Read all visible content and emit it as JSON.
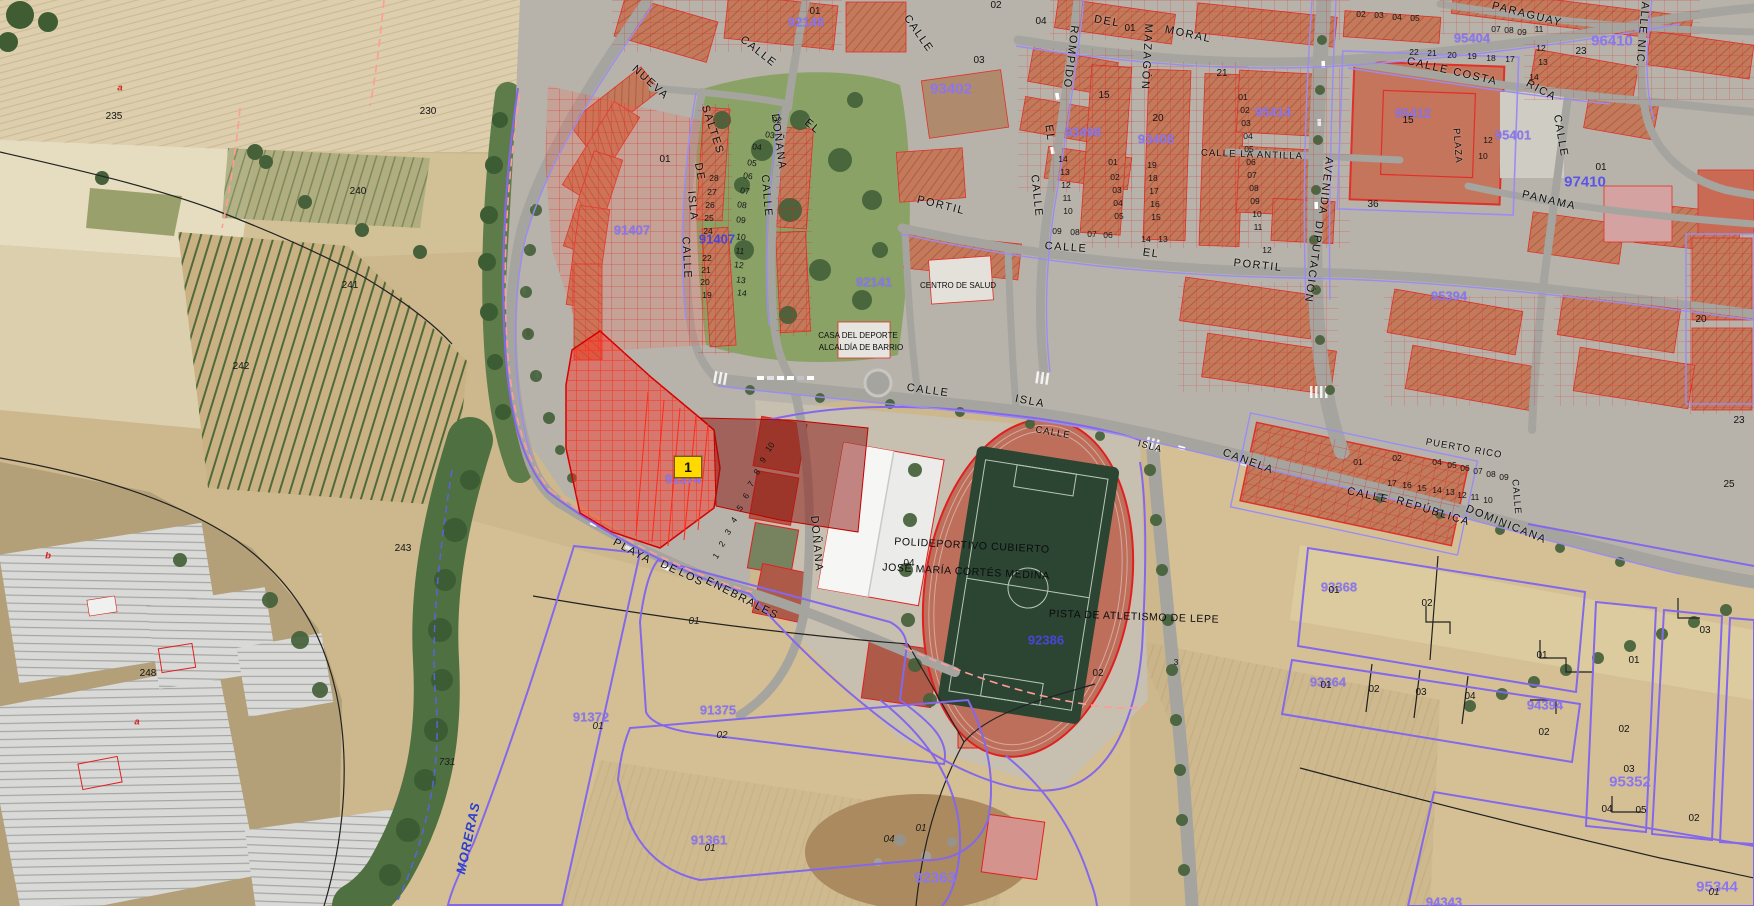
{
  "colors": {
    "cadastral_red": "#e02020",
    "boundary_purple": "#8468ec",
    "parcel_number_purple": "#8a76ee",
    "parcel_number_blue": "#4746d6",
    "selected_parcel_fill": "#ff2e20",
    "marker_yellow": "#ffd900",
    "water_label_blue": "#2b3fd0",
    "field_tan": "#cdb88e",
    "roof_terracotta": "#c5795b",
    "pitch_green": "#2c4533",
    "track_red": "#bd6f5b"
  },
  "selected_parcel": {
    "marker_label": "1",
    "parcel_number": "91374"
  },
  "facilities": {
    "sports_hall_line1": "POLIDEPORTIVO CUBIERTO",
    "sports_hall_line2": "JOSÉ MARÍA CORTÉS MEDINA",
    "athletics_track": "PISTA DE ATLETISMO DE LEPE",
    "health_center": "CENTRO DE SALUD",
    "sports_house_line1": "CASA DEL DEPORTE",
    "sports_house_line2": "ALCALDÍA DE BARRIO"
  },
  "map_labels": [
    [
      "CALLE",
      758,
      52,
      38,
      "st"
    ],
    [
      "NUEVA",
      650,
      83,
      42,
      "st"
    ],
    [
      "SALTES",
      712,
      130,
      72,
      "st"
    ],
    [
      "DE",
      699,
      172,
      80,
      "st"
    ],
    [
      "ISLA",
      692,
      206,
      84,
      "st"
    ],
    [
      "CALLE",
      686,
      258,
      87,
      "st"
    ],
    [
      "DOÑANA",
      778,
      142,
      82,
      "st"
    ],
    [
      "CALLE",
      766,
      196,
      85,
      "st"
    ],
    [
      "EL",
      812,
      127,
      40,
      "st"
    ],
    [
      "CALLE",
      918,
      34,
      55,
      "st"
    ],
    [
      "DEL",
      1107,
      22,
      10,
      "st"
    ],
    [
      "MORAL",
      1188,
      35,
      12,
      "st"
    ],
    [
      "ROMPIDO",
      1070,
      57,
      97,
      "st"
    ],
    [
      "EL",
      1049,
      133,
      82,
      "st"
    ],
    [
      "CALLE",
      1036,
      196,
      84,
      "st"
    ],
    [
      "MAZAGÓN",
      1146,
      57,
      93,
      "st"
    ],
    [
      "PORTIL",
      941,
      206,
      14,
      "st"
    ],
    [
      "CALLE",
      1066,
      248,
      4,
      "st"
    ],
    [
      "EL",
      1151,
      254,
      8,
      "st"
    ],
    [
      "PORTIL",
      1258,
      266,
      6,
      "st"
    ],
    [
      "CALLE COSTA",
      1452,
      72,
      13,
      "st"
    ],
    [
      "RICA",
      1541,
      91,
      28,
      "st"
    ],
    [
      "PARAGUAY",
      1527,
      15,
      14,
      "st"
    ],
    [
      "PANAMA",
      1549,
      201,
      13,
      "st"
    ],
    [
      "CALLE",
      1560,
      136,
      80,
      "st"
    ],
    [
      "CALLE NIC.",
      1642,
      30,
      95,
      "st"
    ],
    [
      "AVENIDA",
      1325,
      186,
      97,
      "st"
    ],
    [
      "DIPUTACIÓN",
      1313,
      262,
      98,
      "st"
    ],
    [
      "CALLE LA ANTILLA",
      1252,
      155,
      2,
      "stS"
    ],
    [
      "PLAZA",
      1457,
      146,
      86,
      "stS"
    ],
    [
      "CALLE",
      1368,
      496,
      12,
      "st"
    ],
    [
      "REPÚBLICA",
      1433,
      512,
      17,
      "st"
    ],
    [
      "DOMINICANA",
      1506,
      525,
      22,
      "st"
    ],
    [
      "PUERTO RICO",
      1464,
      449,
      10,
      "stS"
    ],
    [
      "CALLE",
      928,
      391,
      8,
      "st"
    ],
    [
      "ISLA",
      1030,
      402,
      11,
      "st"
    ],
    [
      "CALLE",
      1053,
      433,
      10,
      "stS"
    ],
    [
      "ISLA",
      1150,
      447,
      15,
      "stS"
    ],
    [
      "CANELA",
      1248,
      462,
      20,
      "st"
    ],
    [
      "PLAYA",
      632,
      552,
      28,
      "st"
    ],
    [
      "DE",
      669,
      568,
      26,
      "st"
    ],
    [
      "LOS",
      691,
      578,
      26,
      "st"
    ],
    [
      "ENEBRALES",
      742,
      599,
      27,
      "st"
    ],
    [
      "DOÑANA",
      816,
      544,
      85,
      "st"
    ],
    [
      "CALLE",
      1516,
      497,
      85,
      "stS"
    ],
    [
      "MORERAS",
      468,
      838,
      -78,
      "wat"
    ],
    [
      "POLIDEPORTIVO CUBIERTO",
      972,
      546,
      3,
      "fac"
    ],
    [
      "JOSÉ MARÍA CORTÉS MEDINA",
      966,
      572,
      3,
      "fac"
    ],
    [
      "PISTA DE ATLETISMO DE LEPE",
      1134,
      617,
      2,
      "fac"
    ],
    [
      "CENTRO DE SALUD",
      958,
      286,
      0,
      "f8"
    ],
    [
      "CASA DEL DEPORTE",
      858,
      336,
      0,
      "f8"
    ],
    [
      "ALCALDÍA DE BARRIO",
      861,
      348,
      0,
      "f8"
    ],
    [
      "92148",
      806,
      22,
      0,
      "pn"
    ],
    [
      "91407",
      632,
      230,
      0,
      "pn"
    ],
    [
      "91407",
      717,
      239,
      0,
      "pnb"
    ],
    [
      "92141",
      874,
      282,
      0,
      "pn"
    ],
    [
      "93402",
      951,
      89,
      0,
      "pnL"
    ],
    [
      "93498",
      1083,
      132,
      0,
      "pn"
    ],
    [
      "93408",
      1156,
      139,
      0,
      "pn"
    ],
    [
      "95414",
      1273,
      112,
      0,
      "pn"
    ],
    [
      "95412",
      1413,
      113,
      0,
      "pn"
    ],
    [
      "95404",
      1472,
      38,
      0,
      "pn"
    ],
    [
      "95401",
      1513,
      135,
      0,
      "pn"
    ],
    [
      "95394",
      1449,
      296,
      0,
      "pn"
    ],
    [
      "96410",
      1612,
      41,
      0,
      "pnL"
    ],
    [
      "97410",
      1585,
      182,
      0,
      "pnbL"
    ],
    [
      "92386",
      1046,
      640,
      0,
      "pnb"
    ],
    [
      "91372",
      591,
      717,
      0,
      "pn"
    ],
    [
      "91375",
      718,
      710,
      0,
      "pn"
    ],
    [
      "91361",
      709,
      840,
      0,
      "pn"
    ],
    [
      "92363",
      935,
      878,
      0,
      "pnL"
    ],
    [
      "93368",
      1339,
      587,
      0,
      "pn"
    ],
    [
      "93364",
      1328,
      682,
      0,
      "pn"
    ],
    [
      "94394",
      1545,
      705,
      0,
      "pn"
    ],
    [
      "95352",
      1630,
      782,
      0,
      "pnL"
    ],
    [
      "95344",
      1717,
      887,
      0,
      "pnL"
    ],
    [
      "94343",
      1444,
      902,
      0,
      "pn"
    ],
    [
      "91374",
      683,
      479,
      0,
      "pn"
    ],
    [
      "235",
      114,
      117,
      0,
      "n"
    ],
    [
      "230",
      428,
      112,
      0,
      "n"
    ],
    [
      "240",
      358,
      192,
      0,
      "n"
    ],
    [
      "241",
      350,
      286,
      0,
      "n"
    ],
    [
      "242",
      241,
      367,
      0,
      "n"
    ],
    [
      "243",
      403,
      549,
      0,
      "n"
    ],
    [
      "248",
      148,
      674,
      0,
      "n"
    ],
    [
      "731",
      447,
      763,
      0,
      "ni"
    ],
    [
      "a",
      120,
      88,
      0,
      "nr"
    ],
    [
      "b",
      48,
      556,
      0,
      "nr"
    ],
    [
      "a",
      137,
      722,
      0,
      "nr"
    ],
    [
      "01",
      598,
      727,
      0,
      "ni"
    ],
    [
      "02",
      722,
      736,
      0,
      "ni"
    ],
    [
      "01",
      710,
      849,
      0,
      "ni"
    ],
    [
      "04",
      889,
      840,
      0,
      "ni"
    ],
    [
      "01",
      921,
      829,
      0,
      "ni"
    ],
    [
      "01",
      694,
      622,
      0,
      "ni"
    ],
    [
      "02",
      1098,
      674,
      0,
      "n"
    ],
    [
      "3",
      1176,
      662,
      0,
      "n8"
    ],
    [
      "04",
      909,
      564,
      0,
      "n"
    ],
    [
      "01",
      1334,
      591,
      0,
      "n"
    ],
    [
      "02",
      1427,
      604,
      0,
      "n"
    ],
    [
      "01",
      1326,
      686,
      0,
      "n"
    ],
    [
      "02",
      1374,
      690,
      0,
      "n"
    ],
    [
      "03",
      1421,
      693,
      0,
      "n"
    ],
    [
      "04",
      1470,
      697,
      0,
      "n"
    ],
    [
      "01",
      1542,
      656,
      0,
      "n"
    ],
    [
      "01",
      1634,
      661,
      0,
      "n"
    ],
    [
      "03",
      1705,
      631,
      0,
      "n"
    ],
    [
      "02",
      1544,
      733,
      0,
      "n"
    ],
    [
      "02",
      1624,
      730,
      0,
      "n"
    ],
    [
      "03",
      1629,
      770,
      0,
      "n"
    ],
    [
      "04",
      1607,
      810,
      0,
      "n"
    ],
    [
      "05",
      1641,
      811,
      0,
      "n"
    ],
    [
      "02",
      1694,
      819,
      0,
      "n"
    ],
    [
      "01",
      1714,
      893,
      0,
      "ni"
    ],
    [
      "20",
      1701,
      320,
      0,
      "n"
    ],
    [
      "23",
      1739,
      421,
      0,
      "n"
    ],
    [
      "25",
      1729,
      485,
      0,
      "n"
    ],
    [
      "23",
      1581,
      52,
      0,
      "n"
    ],
    [
      "01",
      1601,
      168,
      0,
      "n"
    ],
    [
      "15",
      1408,
      121,
      0,
      "n"
    ],
    [
      "12",
      1488,
      140,
      0,
      "n8"
    ],
    [
      "10",
      1483,
      156,
      0,
      "n8"
    ],
    [
      "36",
      1373,
      205,
      0,
      "n"
    ],
    [
      "01",
      815,
      12,
      0,
      "n"
    ],
    [
      "01",
      665,
      160,
      0,
      "n"
    ],
    [
      "02",
      996,
      6,
      0,
      "n"
    ],
    [
      "04",
      1041,
      22,
      0,
      "n"
    ],
    [
      "03",
      979,
      61,
      0,
      "n"
    ],
    [
      "15",
      1104,
      96,
      0,
      "n"
    ],
    [
      "20",
      1158,
      119,
      0,
      "n"
    ],
    [
      "21",
      1222,
      74,
      0,
      "n"
    ],
    [
      "01",
      1130,
      29,
      0,
      "n"
    ],
    [
      "01",
      1243,
      97,
      0,
      "n8"
    ],
    [
      "02",
      1245,
      110,
      0,
      "n8"
    ],
    [
      "03",
      1246,
      123,
      0,
      "n8"
    ],
    [
      "04",
      1248,
      136,
      0,
      "n8"
    ],
    [
      "05",
      1249,
      149,
      0,
      "n8"
    ],
    [
      "06",
      1251,
      162,
      0,
      "n8"
    ],
    [
      "07",
      1252,
      175,
      0,
      "n8"
    ],
    [
      "08",
      1254,
      188,
      0,
      "n8"
    ],
    [
      "09",
      1255,
      201,
      0,
      "n8"
    ],
    [
      "10",
      1257,
      214,
      0,
      "n8"
    ],
    [
      "11",
      1258,
      227,
      0,
      "n8"
    ],
    [
      "12",
      1267,
      250,
      0,
      "n8"
    ],
    [
      "14",
      1063,
      159,
      0,
      "n8"
    ],
    [
      "13",
      1065,
      172,
      0,
      "n8"
    ],
    [
      "12",
      1066,
      185,
      0,
      "n8"
    ],
    [
      "11",
      1067,
      198,
      0,
      "n8"
    ],
    [
      "10",
      1068,
      211,
      0,
      "n8"
    ],
    [
      "09",
      1057,
      231,
      0,
      "n8"
    ],
    [
      "08",
      1075,
      232,
      0,
      "n8"
    ],
    [
      "07",
      1092,
      234,
      0,
      "n8"
    ],
    [
      "06",
      1108,
      235,
      0,
      "n8"
    ],
    [
      "01",
      1113,
      162,
      0,
      "n8"
    ],
    [
      "02",
      1115,
      177,
      0,
      "n8"
    ],
    [
      "03",
      1117,
      190,
      0,
      "n8"
    ],
    [
      "04",
      1118,
      203,
      0,
      "n8"
    ],
    [
      "05",
      1119,
      216,
      0,
      "n8"
    ],
    [
      "19",
      1152,
      165,
      0,
      "n8"
    ],
    [
      "18",
      1153,
      178,
      0,
      "n8"
    ],
    [
      "17",
      1154,
      191,
      0,
      "n8"
    ],
    [
      "16",
      1155,
      204,
      0,
      "n8"
    ],
    [
      "15",
      1156,
      217,
      0,
      "n8"
    ],
    [
      "14",
      1146,
      239,
      0,
      "n8"
    ],
    [
      "13",
      1163,
      239,
      0,
      "n8"
    ],
    [
      "02",
      1361,
      14,
      0,
      "n8"
    ],
    [
      "03",
      1379,
      15,
      0,
      "n8"
    ],
    [
      "04",
      1397,
      17,
      0,
      "n8"
    ],
    [
      "05",
      1415,
      18,
      0,
      "n8"
    ],
    [
      "07",
      1496,
      29,
      0,
      "n8"
    ],
    [
      "08",
      1509,
      30,
      0,
      "n8"
    ],
    [
      "09",
      1522,
      32,
      0,
      "n8"
    ],
    [
      "11",
      1539,
      29,
      0,
      "n8"
    ],
    [
      "12",
      1541,
      48,
      0,
      "n8"
    ],
    [
      "13",
      1543,
      62,
      0,
      "n8"
    ],
    [
      "14",
      1534,
      77,
      0,
      "n8"
    ],
    [
      "22",
      1414,
      52,
      0,
      "n8"
    ],
    [
      "21",
      1432,
      53,
      0,
      "n8"
    ],
    [
      "20",
      1452,
      55,
      0,
      "n8"
    ],
    [
      "19",
      1472,
      56,
      0,
      "n8"
    ],
    [
      "18",
      1491,
      58,
      0,
      "n8"
    ],
    [
      "17",
      1510,
      59,
      0,
      "n8"
    ],
    [
      "01",
      1358,
      462,
      0,
      "n8"
    ],
    [
      "02",
      1397,
      458,
      0,
      "n8"
    ],
    [
      "04",
      1437,
      462,
      0,
      "n8"
    ],
    [
      "05",
      1452,
      465,
      0,
      "n8"
    ],
    [
      "06",
      1465,
      468,
      0,
      "n8"
    ],
    [
      "07",
      1478,
      471,
      0,
      "n8"
    ],
    [
      "08",
      1491,
      474,
      0,
      "n8"
    ],
    [
      "09",
      1504,
      477,
      0,
      "n8"
    ],
    [
      "17",
      1392,
      483,
      0,
      "n8"
    ],
    [
      "16",
      1407,
      485,
      0,
      "n8"
    ],
    [
      "15",
      1422,
      488,
      0,
      "n8"
    ],
    [
      "14",
      1437,
      490,
      0,
      "n8"
    ],
    [
      "13",
      1450,
      492,
      0,
      "n8"
    ],
    [
      "12",
      1462,
      495,
      0,
      "n8"
    ],
    [
      "11",
      1475,
      497,
      0,
      "n8"
    ],
    [
      "10",
      1488,
      500,
      0,
      "n8"
    ],
    [
      "02",
      777,
      120,
      8,
      "n8"
    ],
    [
      "03",
      770,
      135,
      8,
      "n8"
    ],
    [
      "04",
      757,
      147,
      8,
      "n8"
    ],
    [
      "05",
      752,
      163,
      8,
      "n8"
    ],
    [
      "06",
      748,
      176,
      8,
      "n8"
    ],
    [
      "07",
      745,
      191,
      8,
      "n8"
    ],
    [
      "08",
      742,
      205,
      8,
      "n8"
    ],
    [
      "09",
      741,
      220,
      8,
      "n8"
    ],
    [
      "10",
      741,
      237,
      8,
      "n8"
    ],
    [
      "11",
      740,
      251,
      8,
      "n8"
    ],
    [
      "12",
      739,
      265,
      8,
      "n8"
    ],
    [
      "13",
      741,
      280,
      8,
      "n8"
    ],
    [
      "14",
      742,
      293,
      8,
      "n8"
    ],
    [
      "28",
      714,
      178,
      0,
      "n8"
    ],
    [
      "27",
      712,
      192,
      0,
      "n8"
    ],
    [
      "26",
      710,
      205,
      0,
      "n8"
    ],
    [
      "25",
      709,
      218,
      0,
      "n8"
    ],
    [
      "24",
      708,
      231,
      0,
      "n8"
    ],
    [
      "22",
      707,
      258,
      0,
      "n8"
    ],
    [
      "21",
      706,
      270,
      0,
      "n8"
    ],
    [
      "20",
      705,
      282,
      0,
      "n8"
    ],
    [
      "19",
      707,
      295,
      0,
      "n8"
    ],
    [
      "1",
      716,
      556,
      -55,
      "n8"
    ],
    [
      "2",
      722,
      544,
      -55,
      "n8"
    ],
    [
      "3",
      728,
      532,
      -55,
      "n8"
    ],
    [
      "4",
      734,
      520,
      -55,
      "n8"
    ],
    [
      "5",
      740,
      508,
      -55,
      "n8"
    ],
    [
      "6",
      746,
      496,
      -55,
      "n8"
    ],
    [
      "7",
      751,
      484,
      -55,
      "n8"
    ],
    [
      "8",
      757,
      472,
      -55,
      "n8"
    ],
    [
      "9",
      763,
      460,
      -55,
      "n8"
    ],
    [
      "10",
      770,
      447,
      -55,
      "n8"
    ]
  ]
}
